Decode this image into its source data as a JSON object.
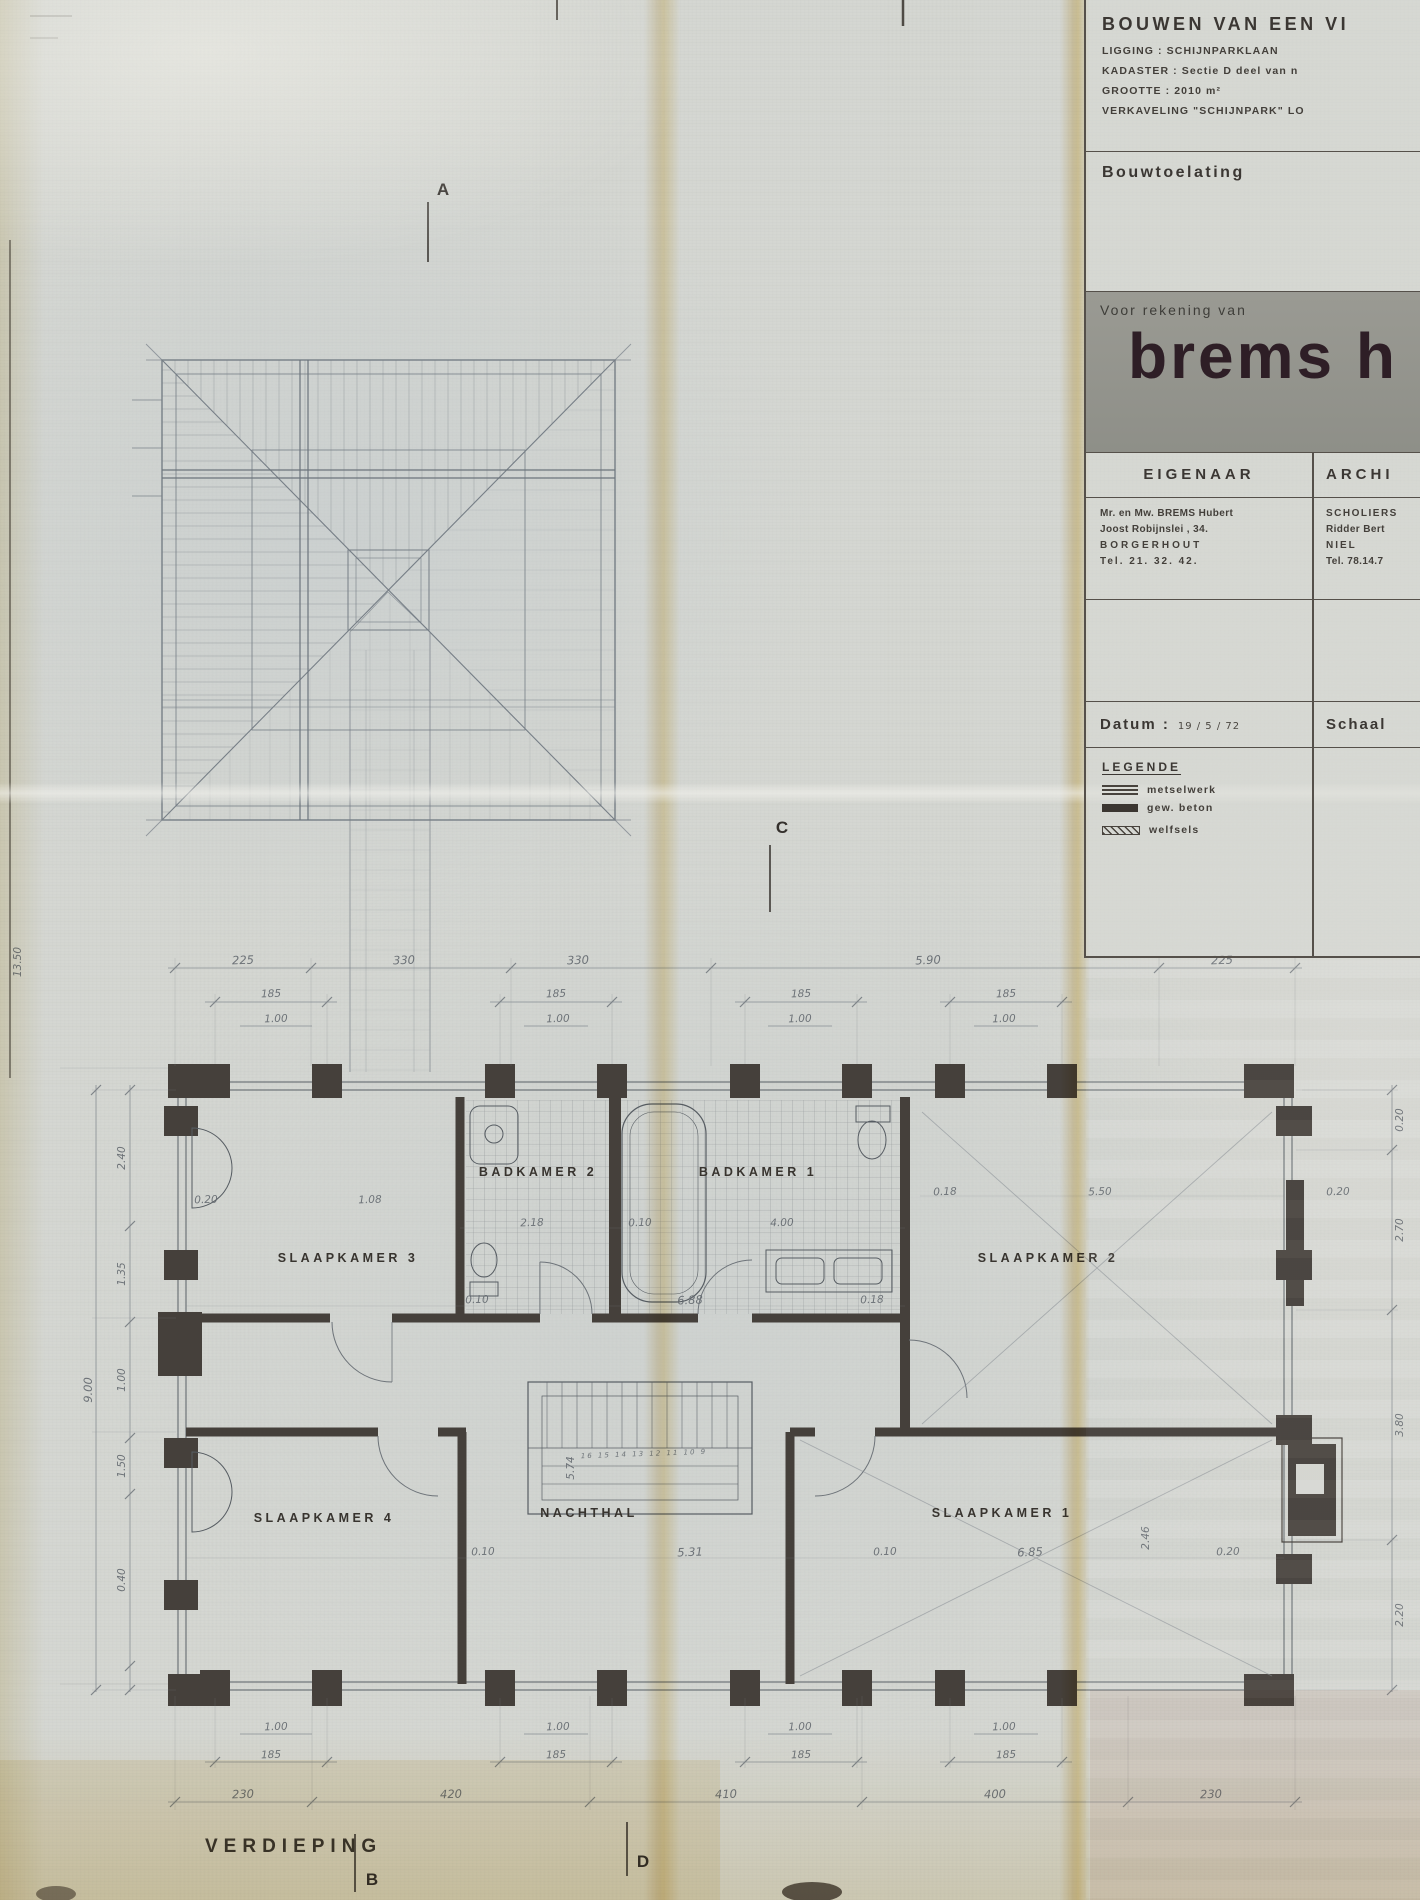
{
  "sheet": {
    "floor_label": "VERDIEPING",
    "section_markers": {
      "a": "A",
      "b": "B",
      "c": "C",
      "d": "D"
    }
  },
  "title_block": {
    "project_title": "BOUWEN VAN EEN VI",
    "info_lines": [
      "LIGGING : SCHIJNPARKLAAN",
      "KADASTER : Sectie D deel van n",
      "GROOTTE : 2010 m²",
      "VERKAVELING \"SCHIJNPARK\" LO"
    ],
    "permit_label": "Bouwtoelating",
    "account_label": "Voor rekening van",
    "client_name": "brems h",
    "owner_header": "EIGENAAR",
    "architect_header": "ARCHI",
    "owner_lines": [
      "Mr. en Mw. BREMS Hubert",
      "Joost Robijnslei , 34.",
      "BORGERHOUT",
      "Tel. 21. 32. 42."
    ],
    "architect_lines": [
      "SCHOLIERS",
      "Ridder Bert",
      "NIEL",
      "Tel. 78.14.7"
    ],
    "date_label": "Datum :",
    "date_value": "19 / 5 / 72",
    "scale_label": "Schaal",
    "legend_header": "LEGENDE",
    "legend_items": [
      "metselwerk",
      "gew. beton",
      "welfsels"
    ]
  },
  "rooms": {
    "badkamer2": "BADKAMER 2",
    "badkamer1": "BADKAMER 1",
    "slaapkamer3": "SLAAPKAMER 3",
    "slaapkamer2": "SLAAPKAMER 2",
    "slaapkamer4": "SLAAPKAMER 4",
    "nachthal": "NACHTHAL",
    "slaapkamer1": "SLAAPKAMER 1"
  },
  "dimensions": {
    "top_bays": [
      "225",
      "330",
      "330",
      "5.90",
      "225"
    ],
    "top_windows": [
      "185",
      "185",
      "185",
      "185"
    ],
    "top_piers": [
      "1.00",
      "1.00",
      "1.00",
      "1.00"
    ],
    "bottom_piers": [
      "1.00",
      "1.00",
      "1.00",
      "1.00"
    ],
    "bottom_windows": [
      "185",
      "185",
      "185",
      "185"
    ],
    "bottom_bays": [
      "230",
      "420",
      "410",
      "400",
      "230"
    ],
    "left_outer": "9.00",
    "left_edge": "13.50",
    "left_chain": [
      "2.40",
      "1.35",
      "1.00",
      "1.50",
      "0.40"
    ],
    "right_chain": [
      "0.20",
      "2.70",
      "3.80",
      "2.20"
    ],
    "upper_row": [
      "0.20",
      "1.08",
      "2.18",
      "0.10",
      "4.00",
      "0.18",
      "5.50",
      "0.20"
    ],
    "corridor_row": [
      "0.10",
      "6.88",
      "0.18"
    ],
    "lower_row": [
      "0.10",
      "5.31",
      "0.10",
      "6.85",
      "0.20"
    ],
    "stair_width": "5.74",
    "stair_steps": "16 15 14 13 12 11 10 9",
    "chimney": "2.46"
  }
}
